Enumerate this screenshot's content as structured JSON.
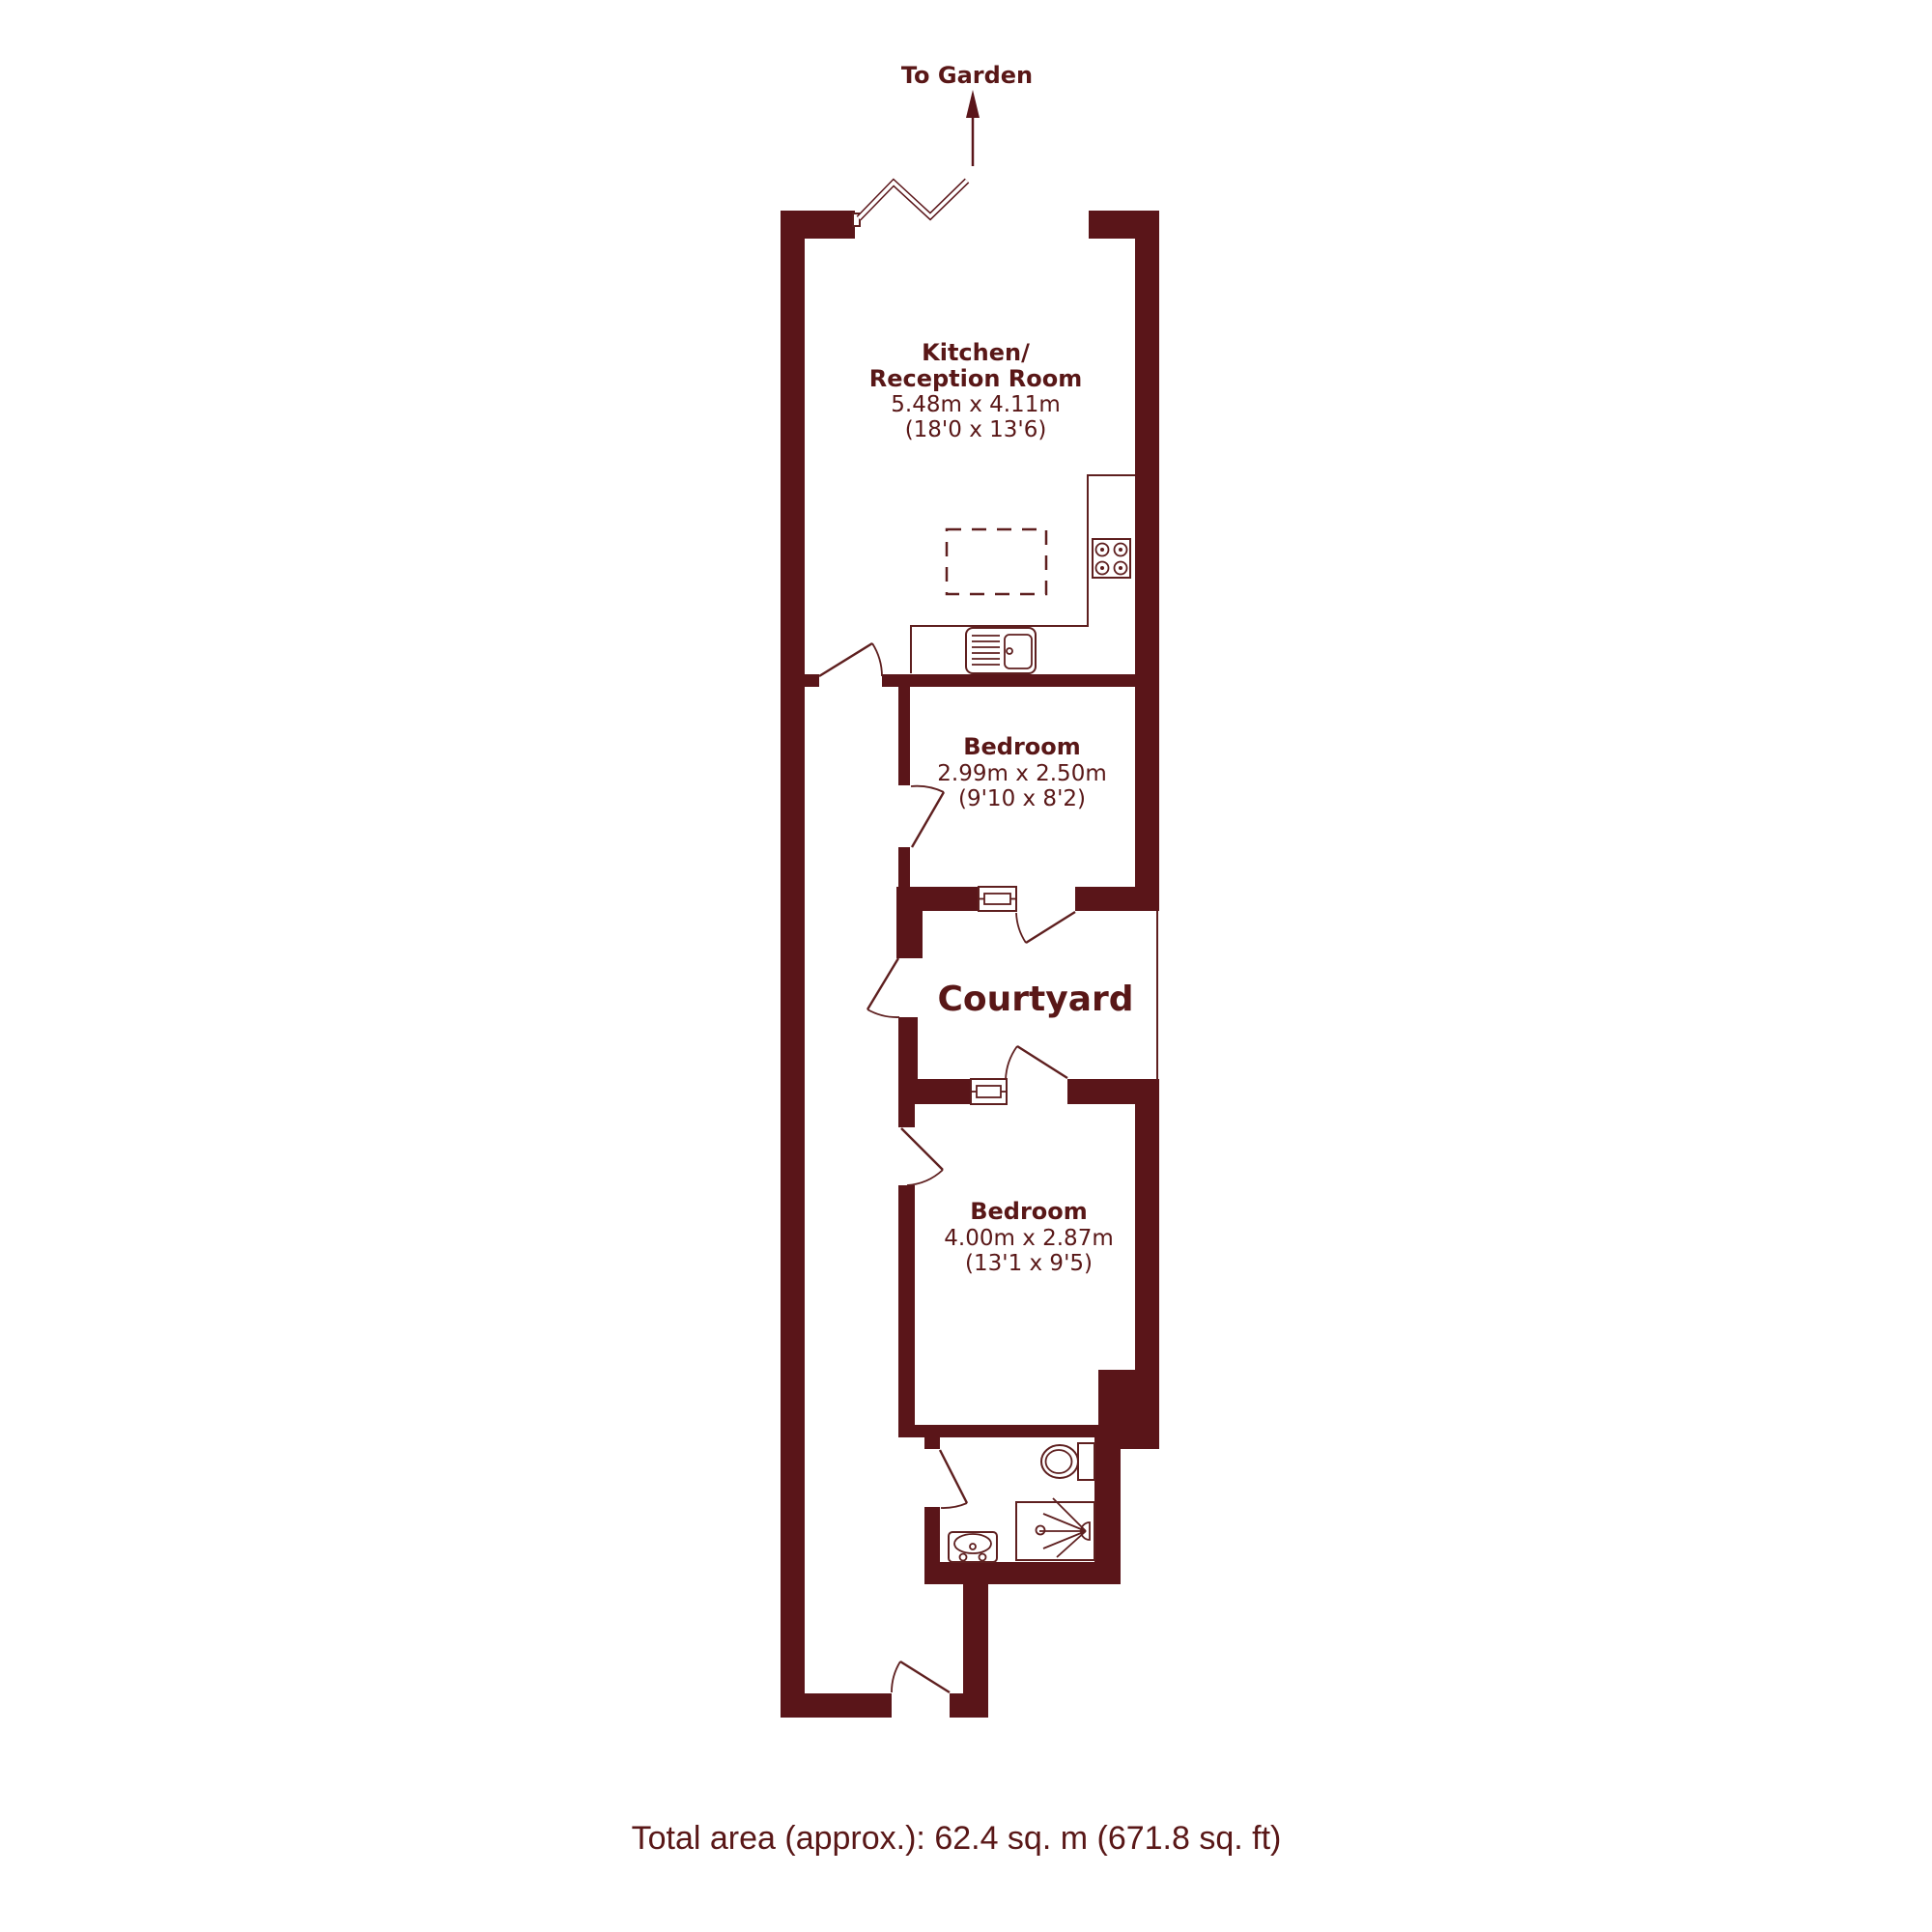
{
  "colors": {
    "wall": "#5a1519",
    "text": "#591717",
    "line": "#5e1f1f",
    "background": "#ffffff"
  },
  "garden": {
    "label": "To Garden"
  },
  "rooms": {
    "kitchen": {
      "line1": "Kitchen/",
      "line2": "Reception Room",
      "metric": "5.48m x 4.11m",
      "imperial": "(18'0 x 13'6)"
    },
    "bedroom1": {
      "name": "Bedroom",
      "metric": "2.99m x 2.50m",
      "imperial": "(9'10 x 8'2)"
    },
    "courtyard": {
      "name": "Courtyard"
    },
    "bedroom2": {
      "name": "Bedroom",
      "metric": "4.00m x 2.87m",
      "imperial": "(13'1 x 9'5)"
    }
  },
  "footer": {
    "total_area": "Total area (approx.): 62.4 sq. m (671.8 sq. ft)"
  }
}
